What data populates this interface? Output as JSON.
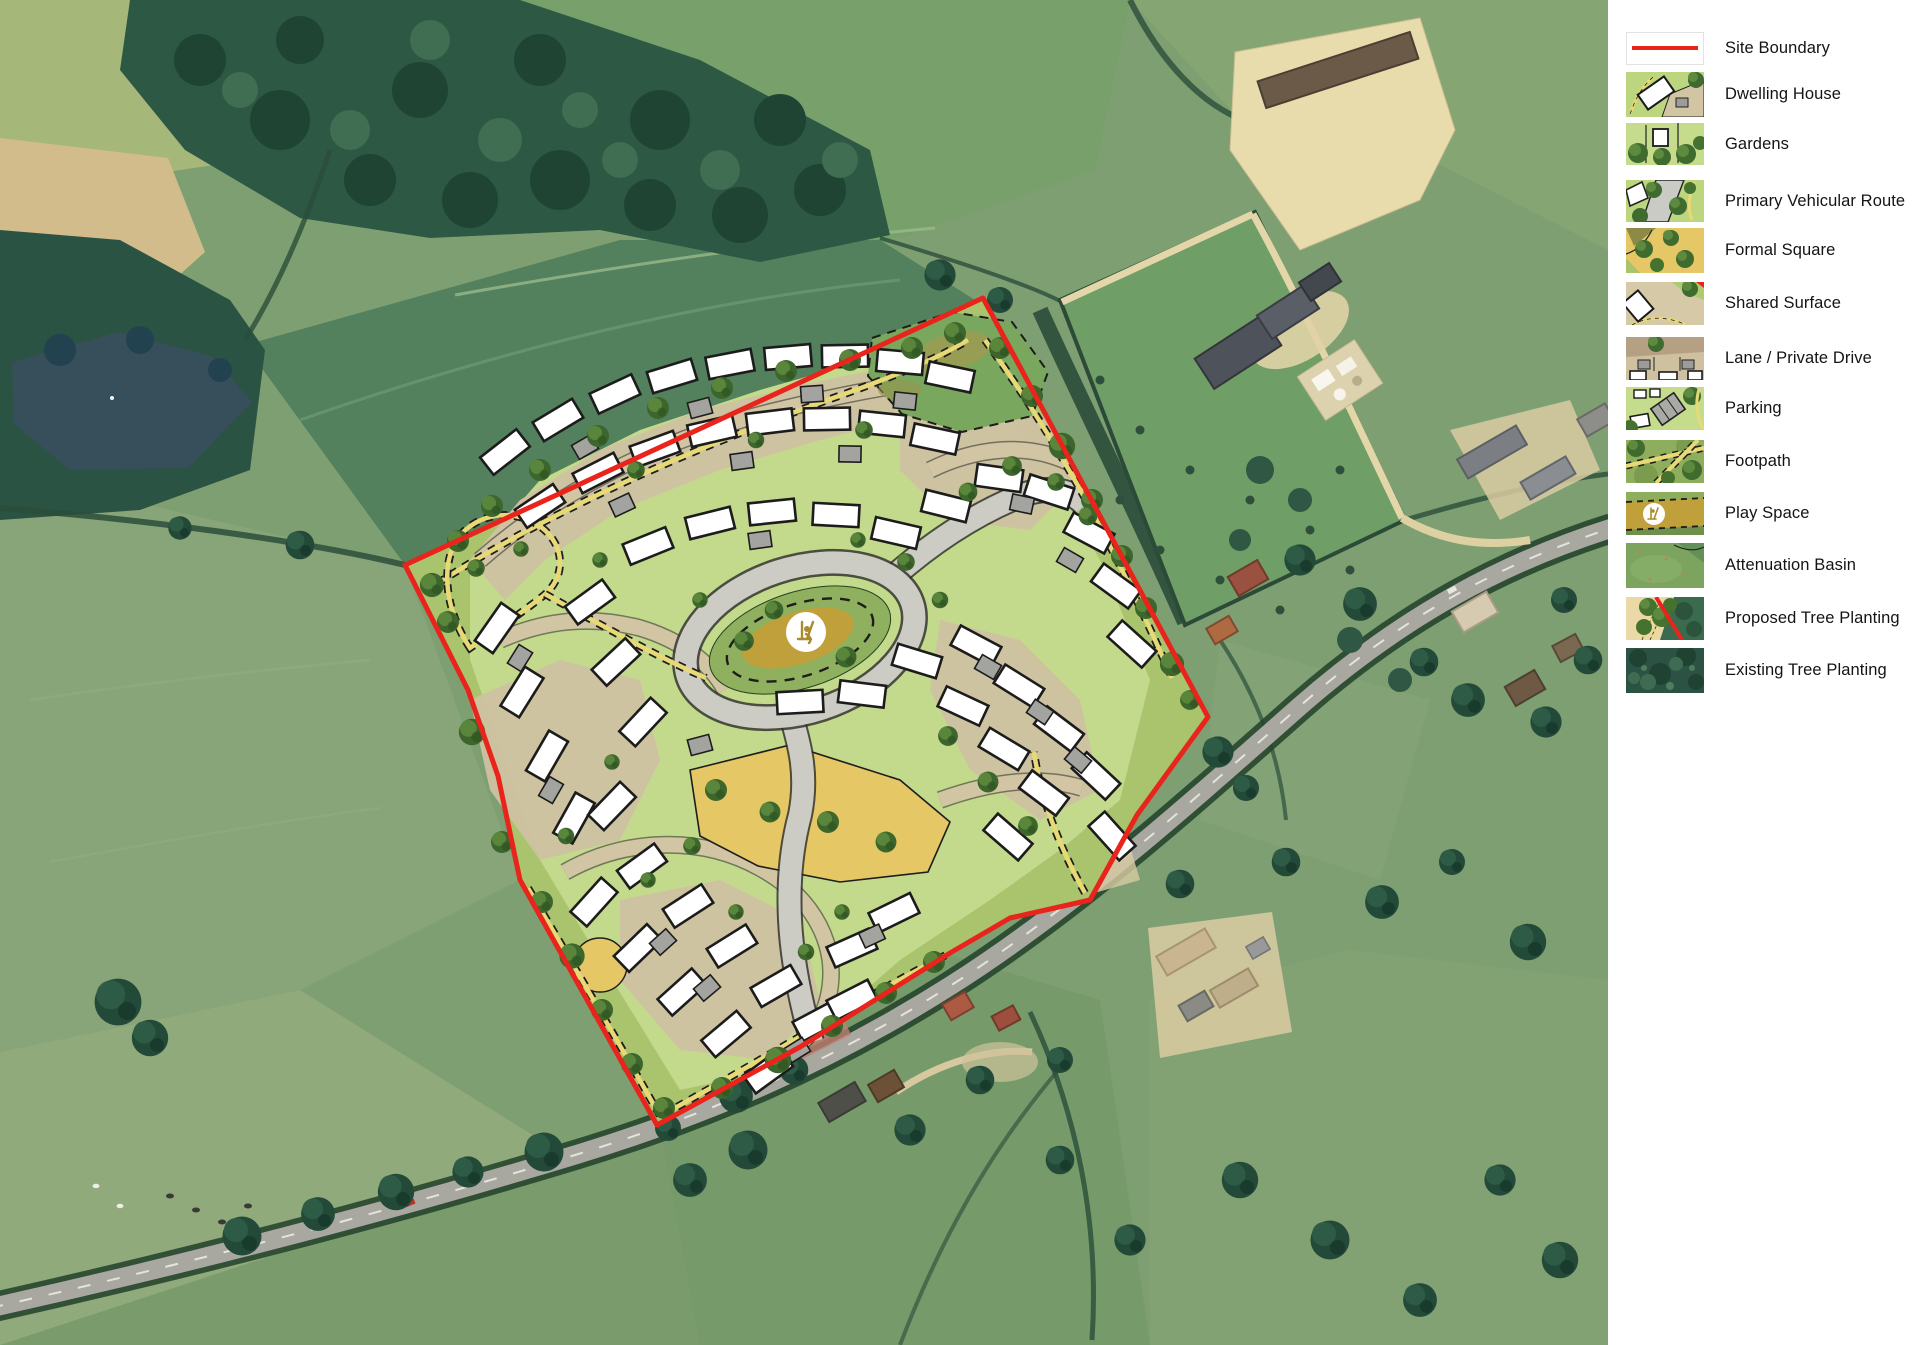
{
  "legend": {
    "items": [
      {
        "id": "site-boundary",
        "label": "Site Boundary"
      },
      {
        "id": "dwelling-house",
        "label": "Dwelling House"
      },
      {
        "id": "gardens",
        "label": "Gardens"
      },
      {
        "id": "primary-vehicular-route",
        "label": "Primary Vehicular Route"
      },
      {
        "id": "formal-square",
        "label": "Formal Square"
      },
      {
        "id": "shared-surface",
        "label": "Shared Surface"
      },
      {
        "id": "lane-private-drive",
        "label": "Lane / Private Drive"
      },
      {
        "id": "parking",
        "label": "Parking"
      },
      {
        "id": "footpath",
        "label": "Footpath"
      },
      {
        "id": "play-space",
        "label": "Play Space"
      },
      {
        "id": "attenuation-basin",
        "label": "Attenuation Basin"
      },
      {
        "id": "proposed-tree-planting",
        "label": "Proposed Tree Planting"
      },
      {
        "id": "existing-tree-planting",
        "label": "Existing Tree Planting"
      }
    ]
  },
  "map": {
    "type": "masterplan-over-aerial",
    "colors": {
      "site_boundary": "#e8241c",
      "dwelling": "#ffffff",
      "gardens": "#c5db8e",
      "primary_route": "#ccccc5",
      "formal_square": "#e5c766",
      "shared_surface": "#d2c5a4",
      "footpath": "#e8d977",
      "play_space": "#bfa03a",
      "attenuation_basin": "#7aa75e",
      "proposed_tree": "#3c662c",
      "existing_tree": "#2c5243"
    },
    "icons": [
      {
        "id": "play-space-icon",
        "glyph": "swing"
      }
    ]
  }
}
